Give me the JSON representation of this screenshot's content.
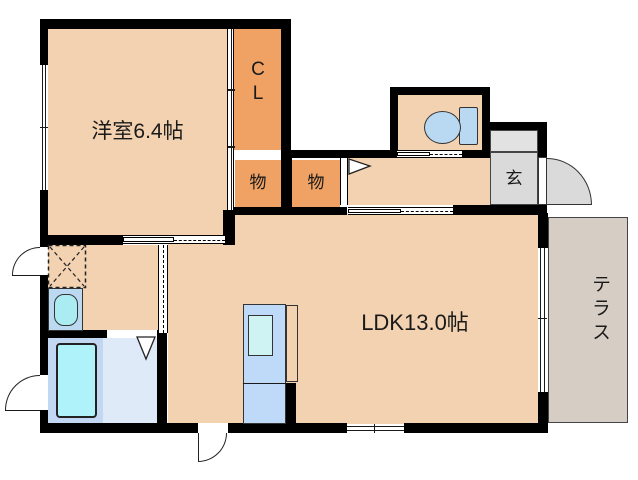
{
  "plan": {
    "title": "apartment floor plan",
    "rooms": {
      "western_room": {
        "label": "洋室6.4帖",
        "floor_color": "#F2D2B0"
      },
      "closet": {
        "label": "C\nL",
        "floor_color": "#EFA263"
      },
      "storage_1": {
        "label": "物",
        "floor_color": "#EFA263"
      },
      "storage_2": {
        "label": "物",
        "floor_color": "#EFA263"
      },
      "entrance": {
        "label": "玄",
        "floor_color": "#DADADA"
      },
      "ldk": {
        "label": "LDK13.0帖",
        "floor_color": "#F2D2B0"
      },
      "terrace": {
        "label": "テラス",
        "floor_color": "#D6CEC4"
      }
    },
    "fixtures": {
      "toilet": "toilet with tank",
      "kitchen": "kitchen counter with sink",
      "bathtub": "bathtub",
      "washbasin": "washbasin",
      "washer_space": "washing machine space (dashed X)"
    },
    "colors": {
      "wall": "#000000",
      "room_peach": "#F2D2B0",
      "closet_orange": "#EFA263",
      "entrance_gray": "#DADADA",
      "terrace_gray": "#D6CEC4",
      "fixture_blue": "#B9D9F2",
      "kitchen_blue": "#BFDAF8",
      "sink_cyan": "#CFF2F2",
      "bath_floor_blue": "#DEEAF8",
      "tub_cyan": "#AFF2FA"
    }
  }
}
